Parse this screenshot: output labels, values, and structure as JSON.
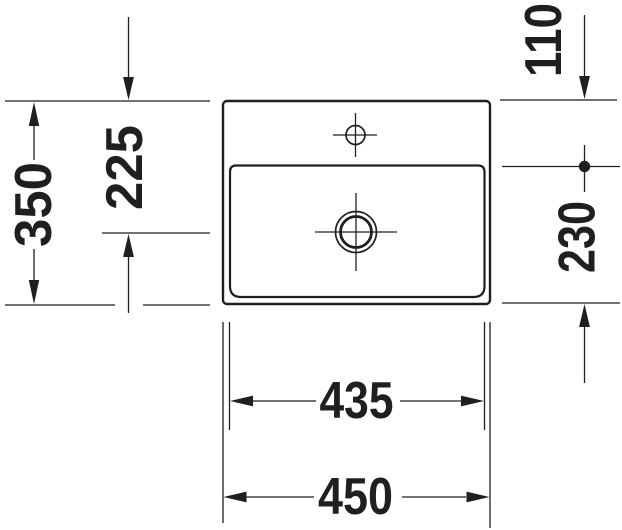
{
  "drawing": {
    "type": "technical-dimension-drawing",
    "subject": "washbasin top view with faucet hole and drain",
    "colors": {
      "line": "#1f1f1f",
      "background": "#ffffff"
    },
    "dimensions": {
      "left_outer": {
        "value": "350",
        "orientation": "vertical"
      },
      "left_inner": {
        "value": "225",
        "orientation": "vertical"
      },
      "right_upper": {
        "value": "110",
        "orientation": "vertical"
      },
      "right_lower": {
        "value": "230",
        "orientation": "vertical"
      },
      "bottom_inner": {
        "value": "435",
        "orientation": "horizontal"
      },
      "bottom_outer": {
        "value": "450",
        "orientation": "horizontal"
      }
    },
    "features": {
      "outer_outline": "rounded rectangle rim",
      "inner_outline": "rounded rectangle bowl",
      "faucet_hole": "circle with centerline cross",
      "drain": "double circle with centerline cross",
      "reference_marker": "filled dot on right extension line"
    }
  }
}
